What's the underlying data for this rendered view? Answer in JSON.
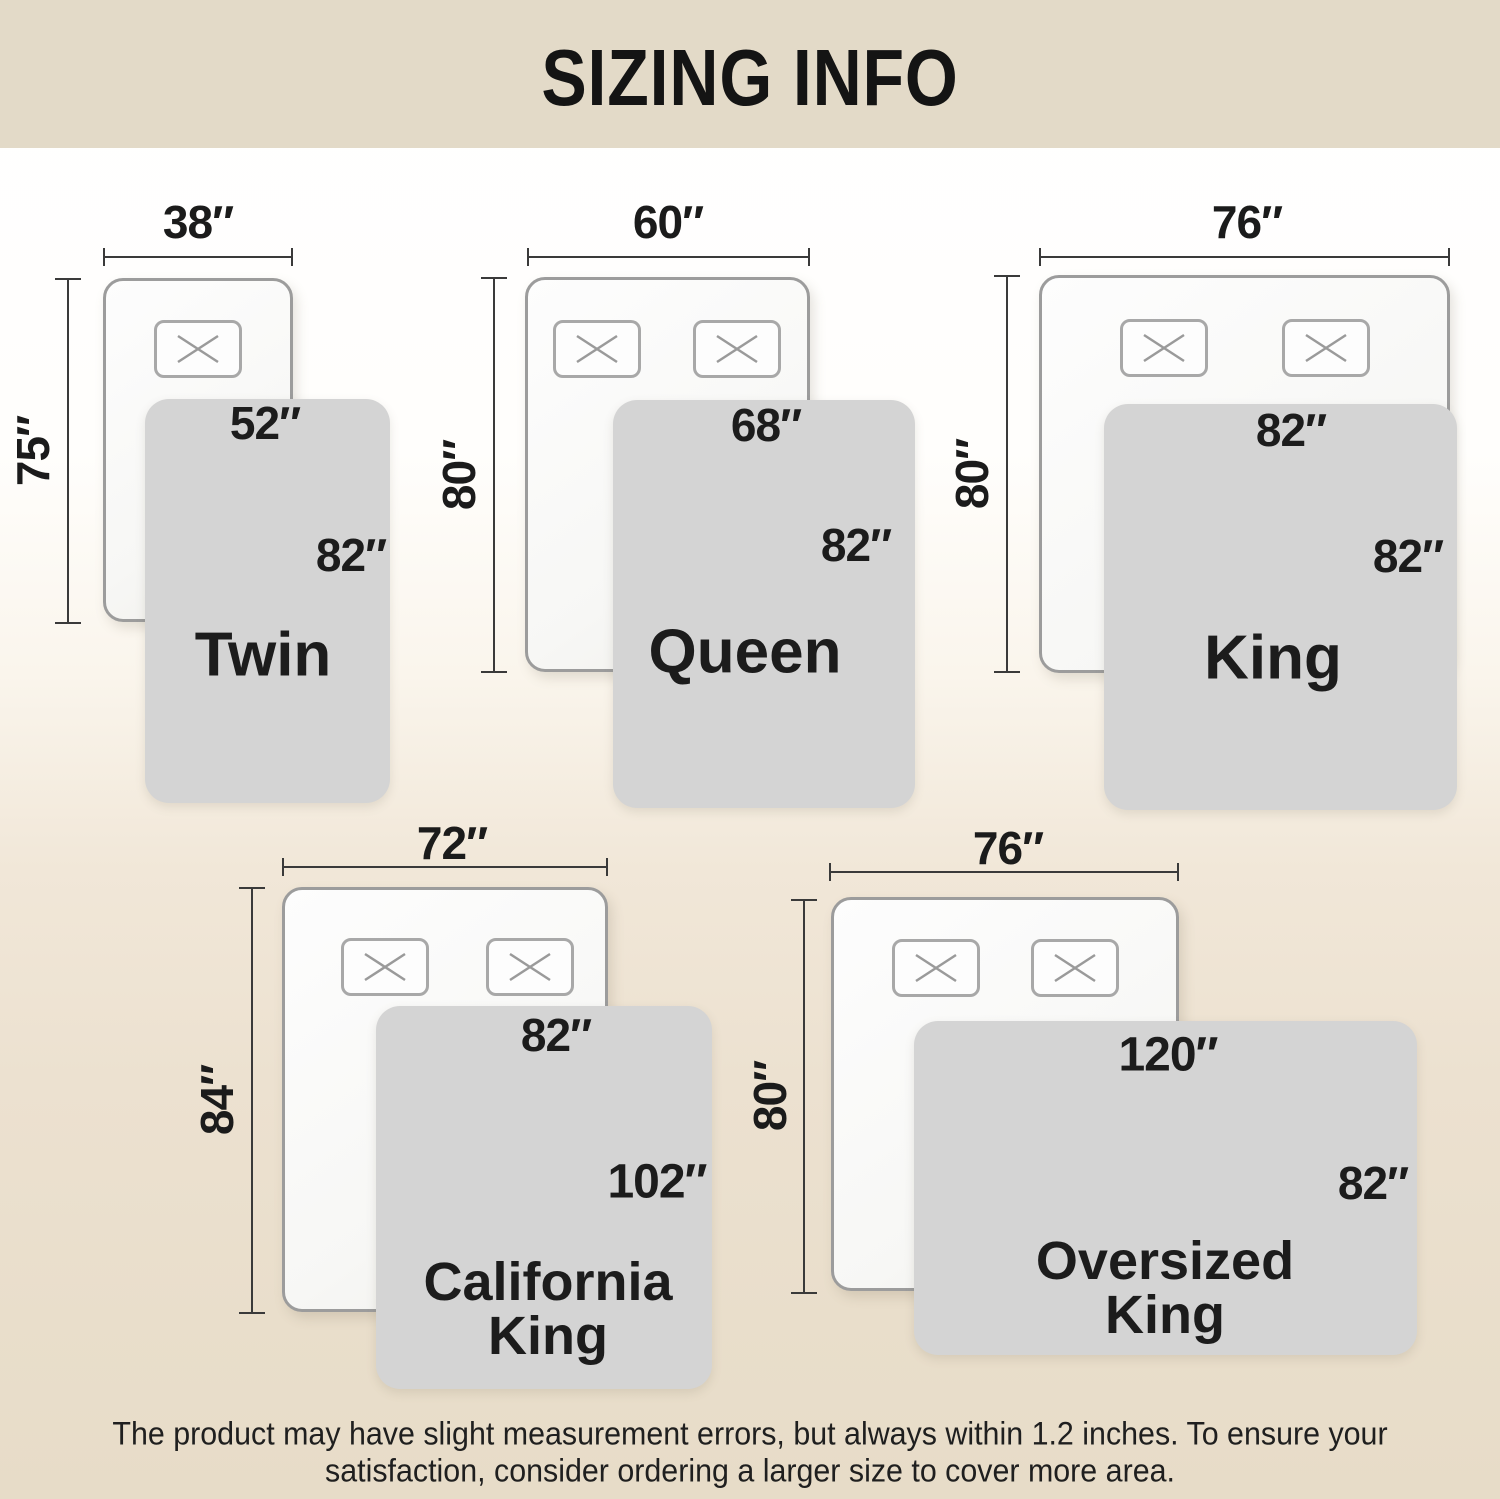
{
  "header": {
    "title": "SIZING INFO"
  },
  "colors": {
    "banner": "#e3dac8",
    "background_top": "#ffffff",
    "background_bottom": "#e7dcc8",
    "blanket": "#d4d4d4",
    "bed_fill": "#f8f8f6",
    "bed_border": "#9c9c9c",
    "dimension_line": "#3a3a3a",
    "text": "#1c1c1c"
  },
  "sizes": [
    {
      "name": "Twin",
      "bed_width": "38″",
      "bed_length": "75″",
      "blanket_width": "52″",
      "blanket_length": "82″",
      "pillows": 1
    },
    {
      "name": "Queen",
      "bed_width": "60″",
      "bed_length": "80″",
      "blanket_width": "68″",
      "blanket_length": "82″",
      "pillows": 2
    },
    {
      "name": "King",
      "bed_width": "76″",
      "bed_length": "80″",
      "blanket_width": "82″",
      "blanket_length": "82″",
      "pillows": 2
    },
    {
      "name": "California King",
      "name_line1": "California",
      "name_line2": "King",
      "bed_width": "72″",
      "bed_length": "84″",
      "blanket_width": "82″",
      "blanket_length": "102″",
      "pillows": 2
    },
    {
      "name": "Oversized King",
      "name_line1": "Oversized",
      "name_line2": "King",
      "bed_width": "76″",
      "bed_length": "80″",
      "blanket_width": "120″",
      "blanket_length": "82″",
      "pillows": 2
    }
  ],
  "footer": {
    "line1": "The product may have slight measurement errors, but always within 1.2 inches. To ensure your",
    "line2": "satisfaction, consider ordering a larger size to cover more area."
  }
}
